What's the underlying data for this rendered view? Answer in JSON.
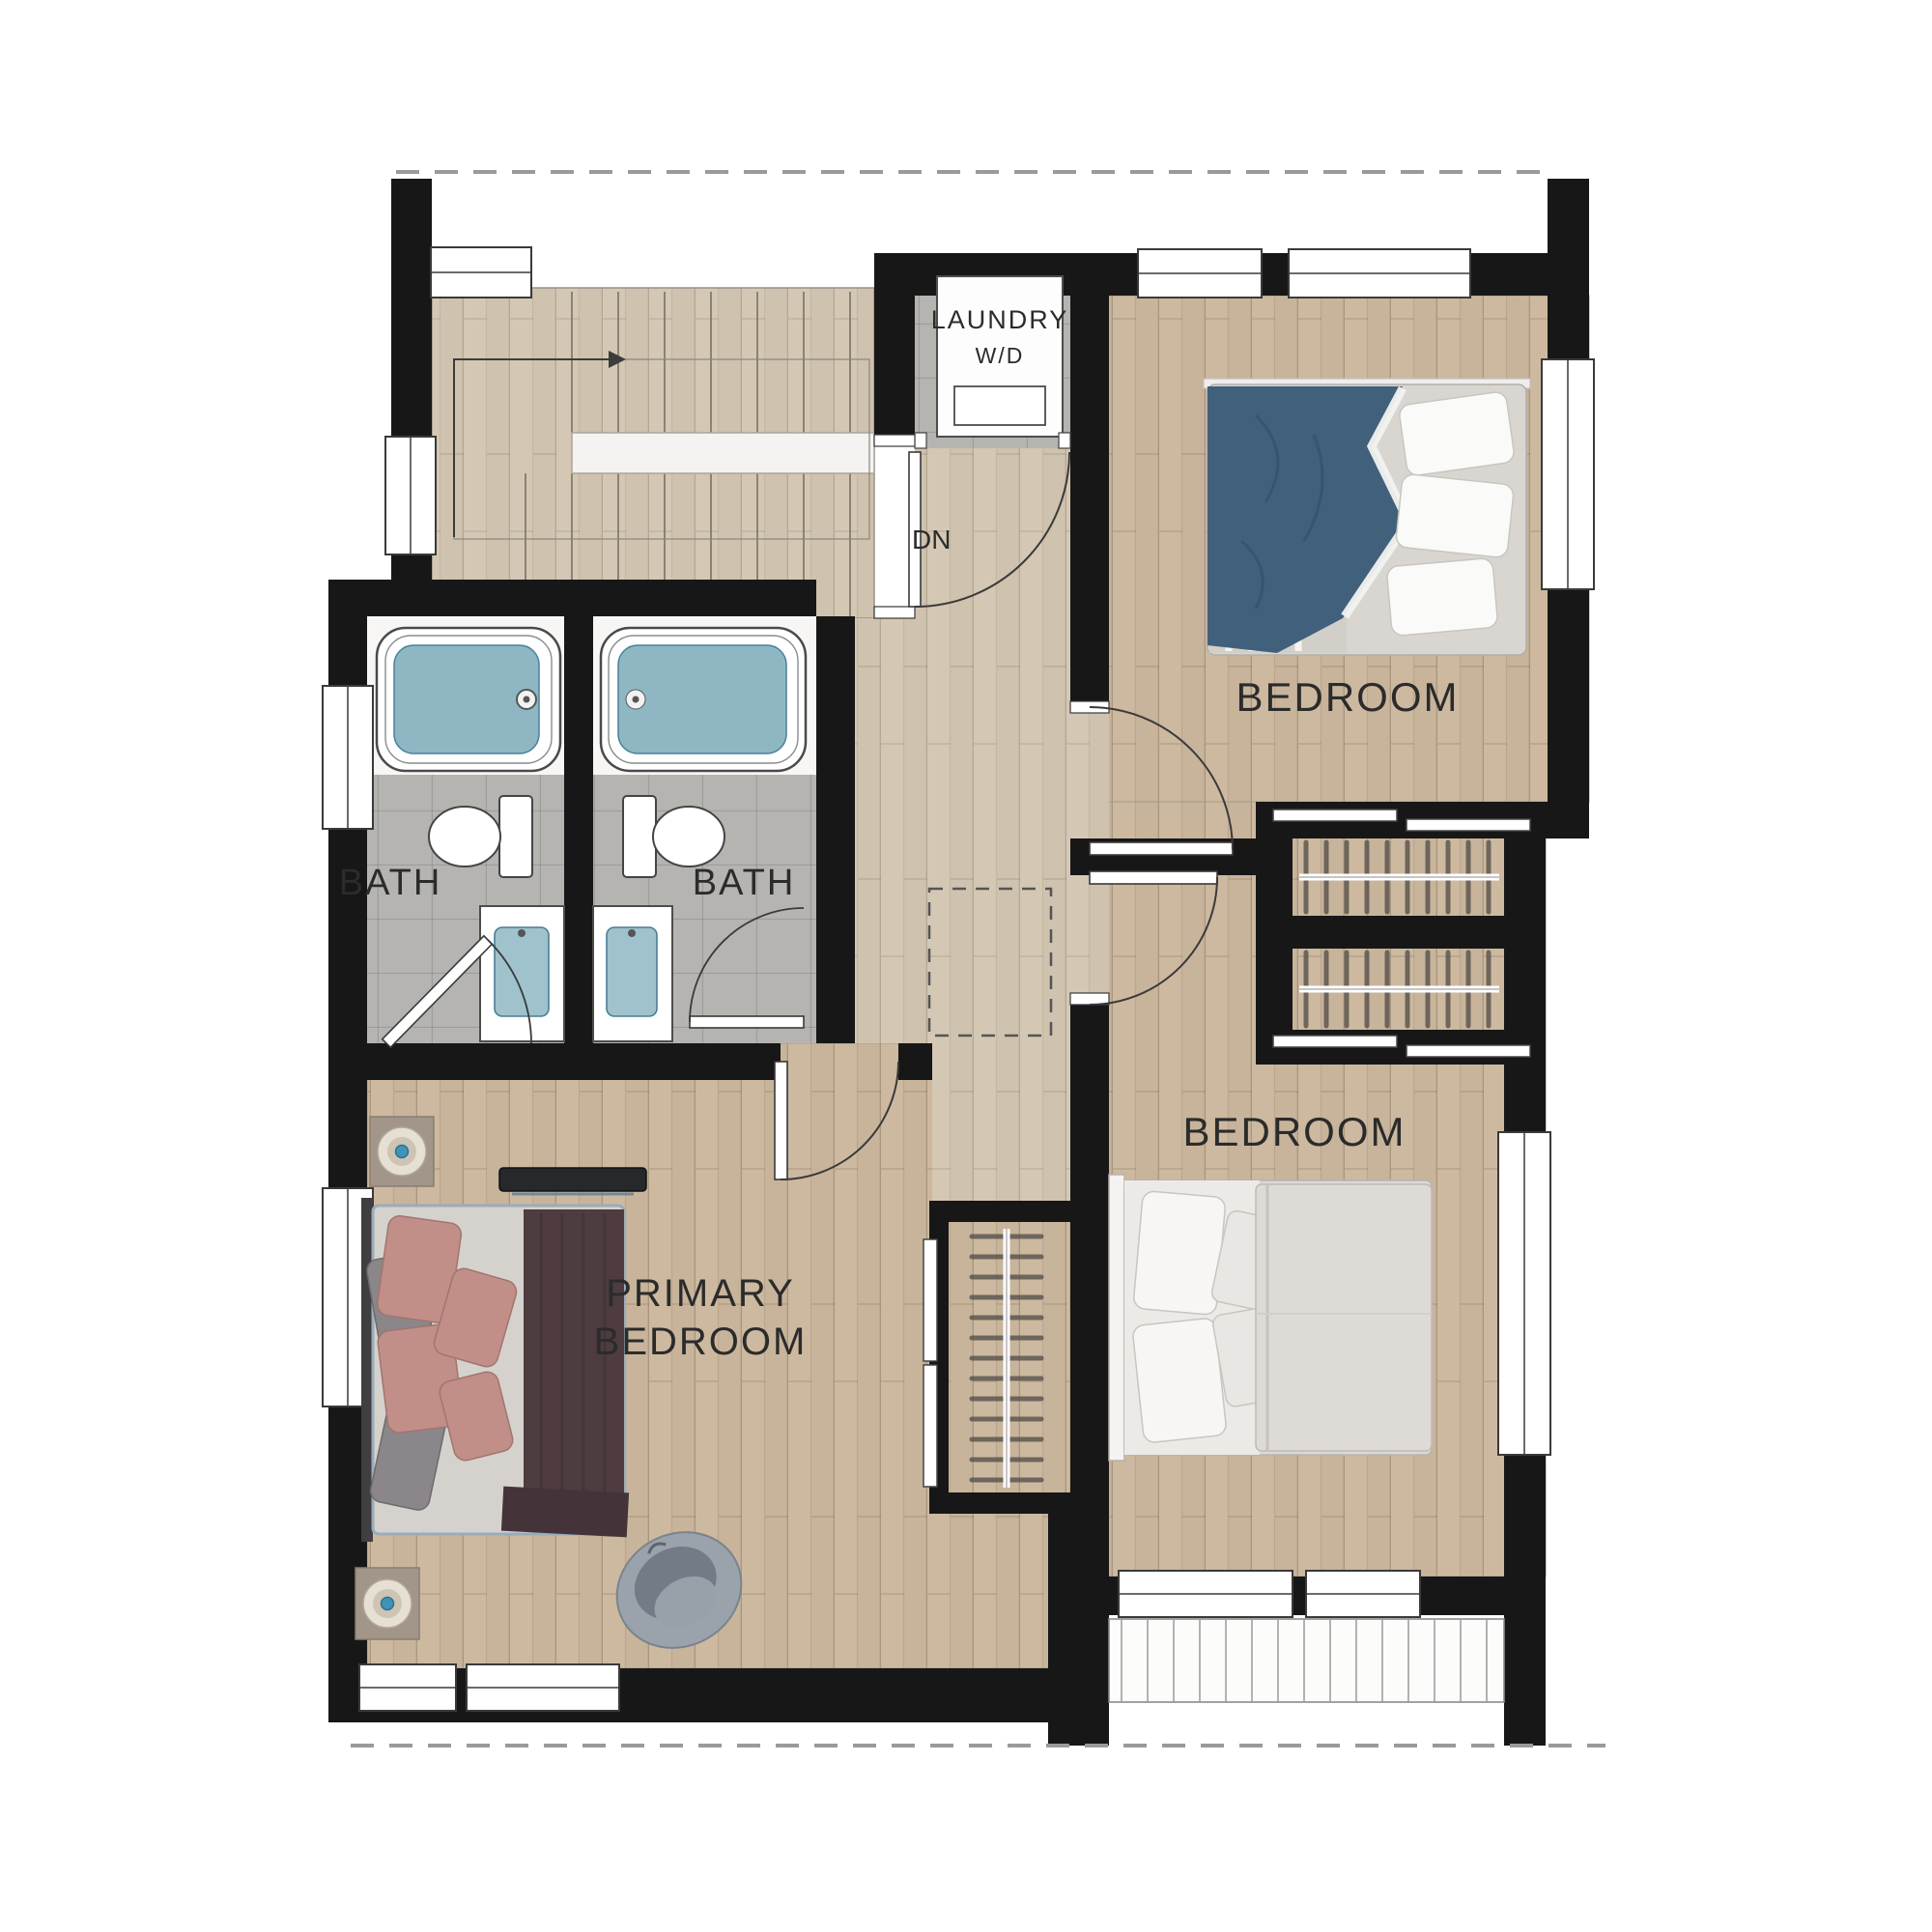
{
  "labels": {
    "laundry": "LAUNDRY",
    "washer_dryer": "W/D",
    "down": "DN",
    "bedroom_top_right": "BEDROOM",
    "bedroom_bottom_right": "BEDROOM",
    "bath_left": "BATH",
    "bath_right": "BATH",
    "primary_bedroom_line1": "PRIMARY",
    "primary_bedroom_line2": "BEDROOM"
  },
  "colors": {
    "wall": "#171717",
    "wood_floor": "#c8b49b",
    "wood_floor_light": "#cfc2ae",
    "bath_tile": "#b6b4b1",
    "tub_water": "#8fb7c3",
    "sink_water": "#9fc2cc",
    "bed_blue": "#41607c",
    "bed_gray": "#dcd9d4",
    "pillow_pink": "#c18f88",
    "blanket_brown": "#4e3c40",
    "chair_gray": "#9aa2ab",
    "label_text": "#2b2b2b",
    "roof_dash": "#9a9a9a"
  }
}
